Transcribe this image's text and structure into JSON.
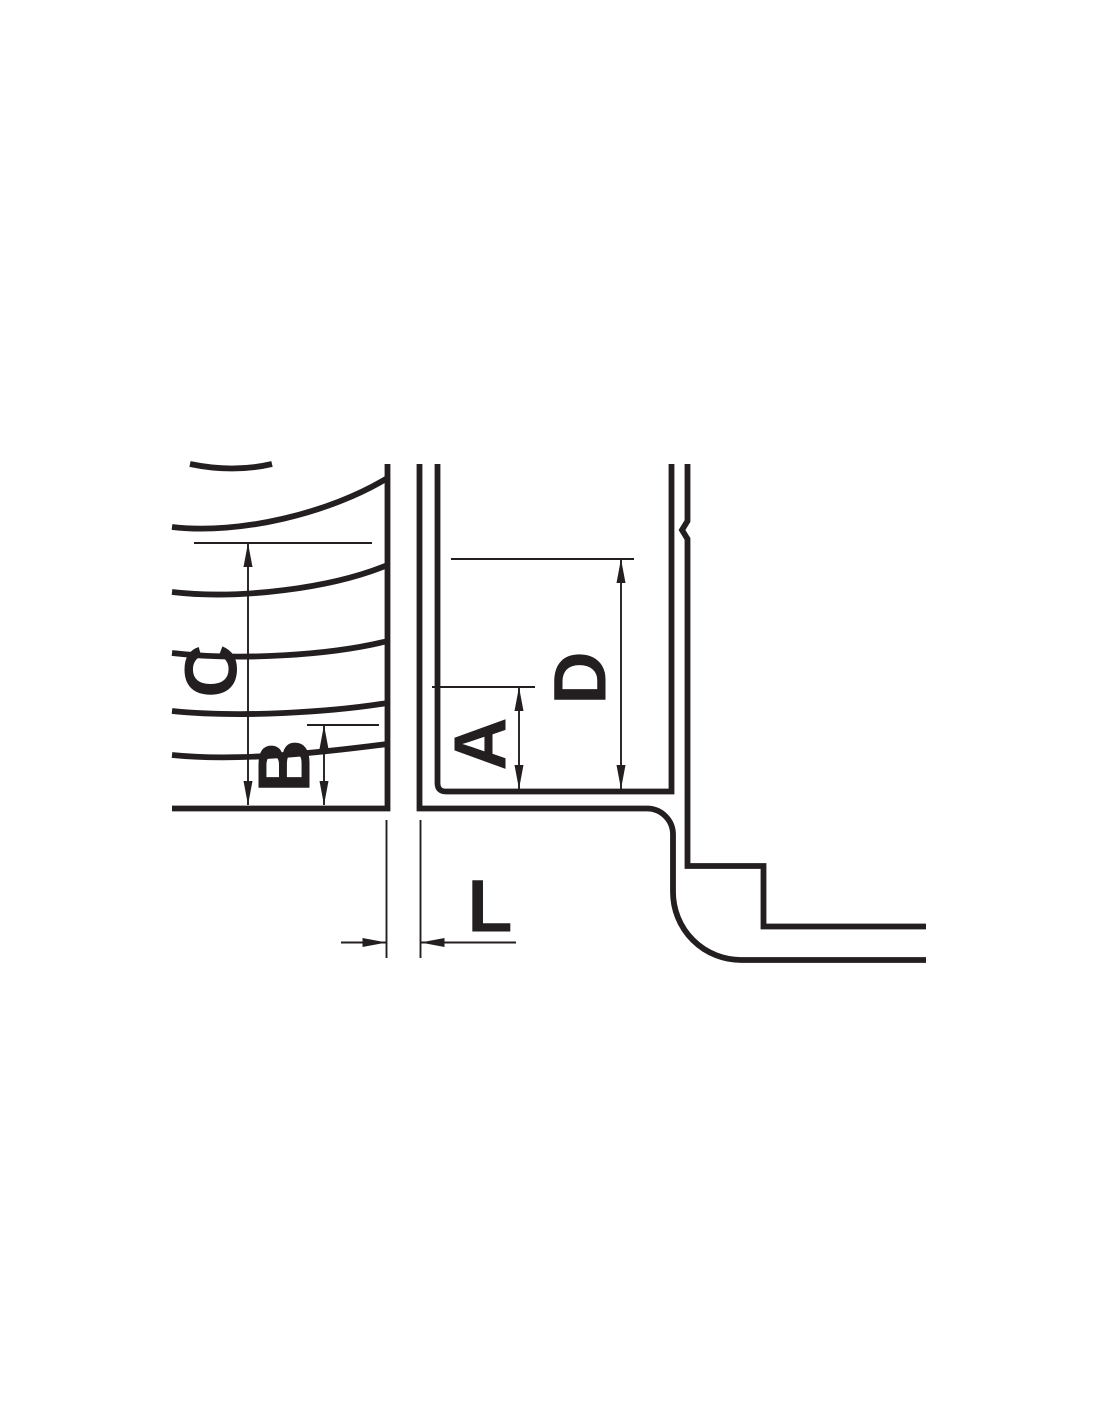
{
  "colors": {
    "ink": "#231f20",
    "background": "#ffffff"
  },
  "drawing": {
    "type": "threaded-pipe-fitting-section",
    "labels": {
      "c": "C",
      "b": "B",
      "a": "A",
      "d": "D",
      "l": "L"
    }
  }
}
